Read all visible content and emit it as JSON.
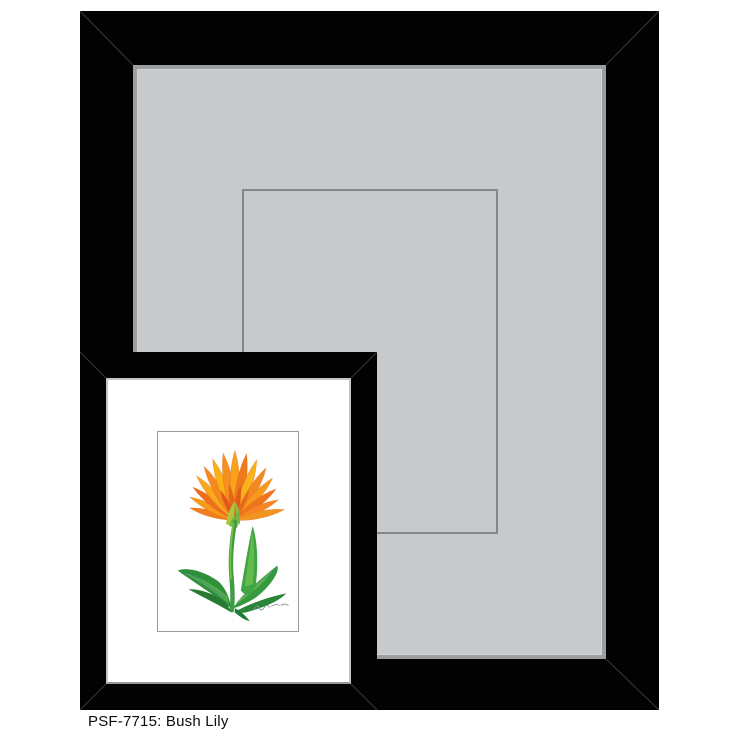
{
  "caption": {
    "text": "PSF-7715: Bush Lily",
    "sku": "PSF-7715",
    "product_name": "Bush Lily"
  },
  "colors": {
    "background": "#ffffff",
    "frame_black": "#020202",
    "mat_gray": "#c8c9cb",
    "mat_bevel": "#9b9ea1",
    "opening_line": "#85888b",
    "small_mat_white": "#ffffff",
    "small_mat_edge": "#c4c5c7",
    "small_mat_shadow": "#97999c",
    "artwork_border": "#9b9b9b",
    "flower_orange": "#f6861f",
    "flower_yellow": "#fbb017",
    "flower_deep_orange": "#e2581b",
    "calyx_green": "#a9c83f",
    "stem_green": "#3e9c45",
    "leaf_green": "#35993f",
    "leaf_dark_green": "#267a33",
    "leaf_highlight": "#66b94c",
    "leaf_blue_streak": "#4c6fc2",
    "signature_gray": "#909090",
    "caption_text": "#0d0d0d"
  },
  "illustration": {
    "subject": "bush-lily-flower",
    "signature_present": true
  }
}
